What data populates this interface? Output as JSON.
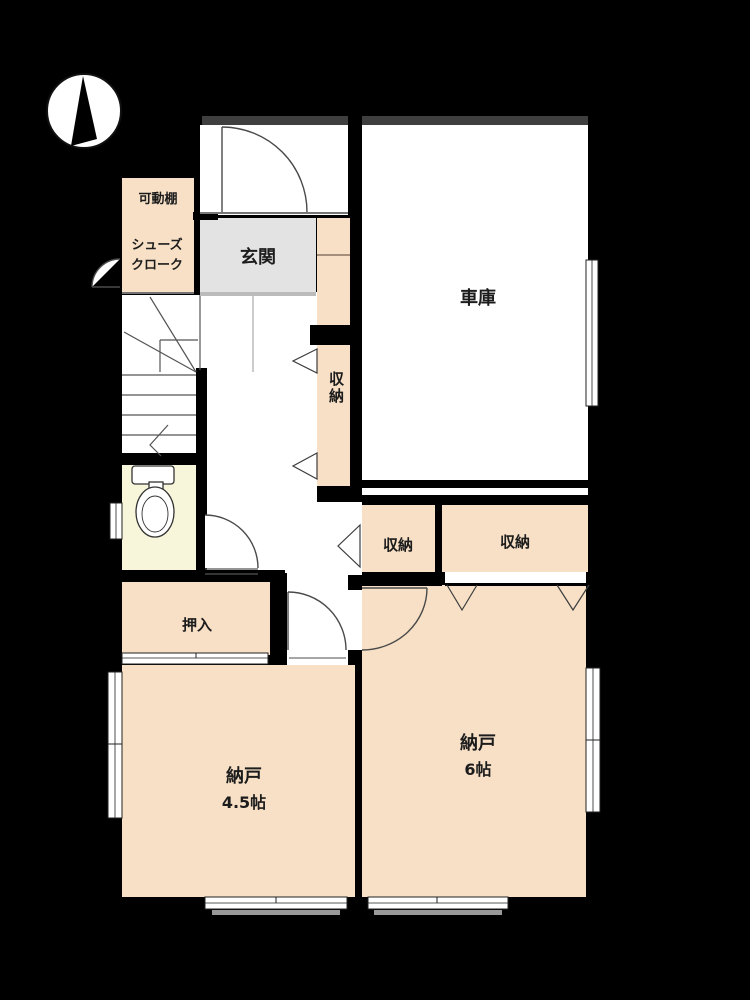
{
  "plan": {
    "type": "japanese-floorplan",
    "compass": {
      "description": "north-arrow"
    },
    "rooms": {
      "movable_shelf": {
        "label": "可動棚"
      },
      "shoe_cloak": {
        "label_line1": "シューズ",
        "label_line2": "クローク"
      },
      "genkan": {
        "label": "玄関"
      },
      "garage": {
        "label": "車庫"
      },
      "closet_tall": {
        "label": "収納"
      },
      "closet_left": {
        "label": "収納"
      },
      "closet_right": {
        "label": "収納"
      },
      "oshiire": {
        "label": "押入"
      },
      "storeroom_small": {
        "label": "納戸",
        "size": "4.5帖"
      },
      "storeroom_large": {
        "label": "納戸",
        "size": "6帖"
      }
    },
    "colors": {
      "background": "#000000",
      "wall": "#000000",
      "room_fill": "#f7e0c6",
      "genkan_fill": "#e3e3e3",
      "toilet_fill": "#f8f6da",
      "floor_white": "#ffffff",
      "shutter_bar": "#3f3f3f",
      "line": "#3c3c3c",
      "window_shadow": "#999999"
    }
  }
}
